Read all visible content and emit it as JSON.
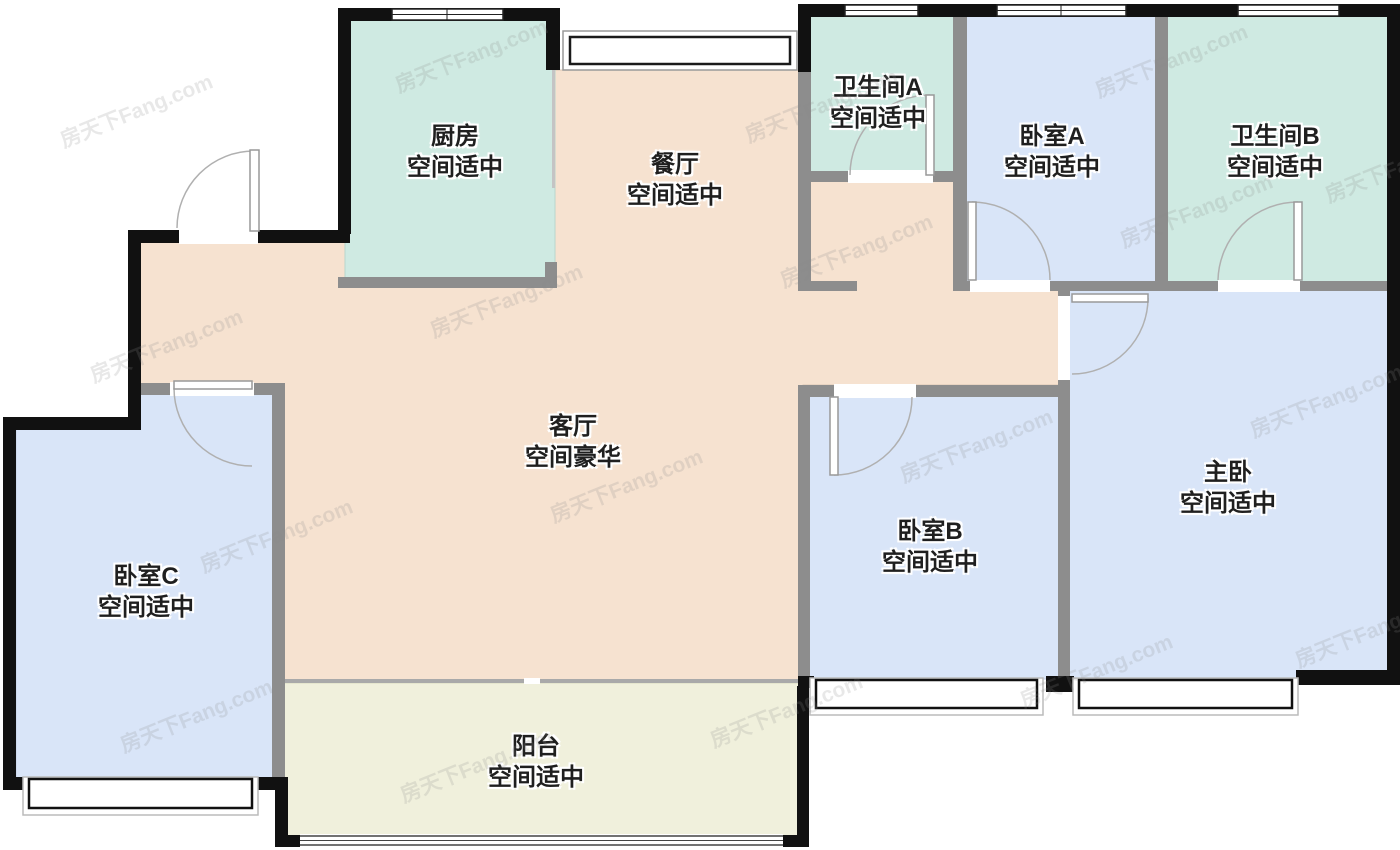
{
  "title": "户型图",
  "watermark": {
    "text": "房天下Fang.com"
  },
  "colors": {
    "beige": "#f6e2d0",
    "teal": "#cfeae2",
    "blue": "#d9e5f8",
    "balcony": "#f0f0dc",
    "wall_black": "#111111",
    "wall_gray": "#8d8d8d",
    "door_line": "#a9a9a9",
    "window_line": "#222222"
  },
  "rooms": [
    {
      "id": "kitchen",
      "name": "厨房",
      "grade": "空间适中"
    },
    {
      "id": "dining",
      "name": "餐厅",
      "grade": "空间适中"
    },
    {
      "id": "bathroom-a",
      "name": "卫生间A",
      "grade": "空间适中"
    },
    {
      "id": "bedroom-a",
      "name": "卧室A",
      "grade": "空间适中"
    },
    {
      "id": "bathroom-b",
      "name": "卫生间B",
      "grade": "空间适中"
    },
    {
      "id": "living",
      "name": "客厅",
      "grade": "空间豪华"
    },
    {
      "id": "bedroom-b",
      "name": "卧室B",
      "grade": "空间适中"
    },
    {
      "id": "master",
      "name": "主卧",
      "grade": "空间适中"
    },
    {
      "id": "bedroom-c",
      "name": "卧室C",
      "grade": "空间适中"
    },
    {
      "id": "balcony",
      "name": "阳台",
      "grade": "空间适中"
    }
  ]
}
